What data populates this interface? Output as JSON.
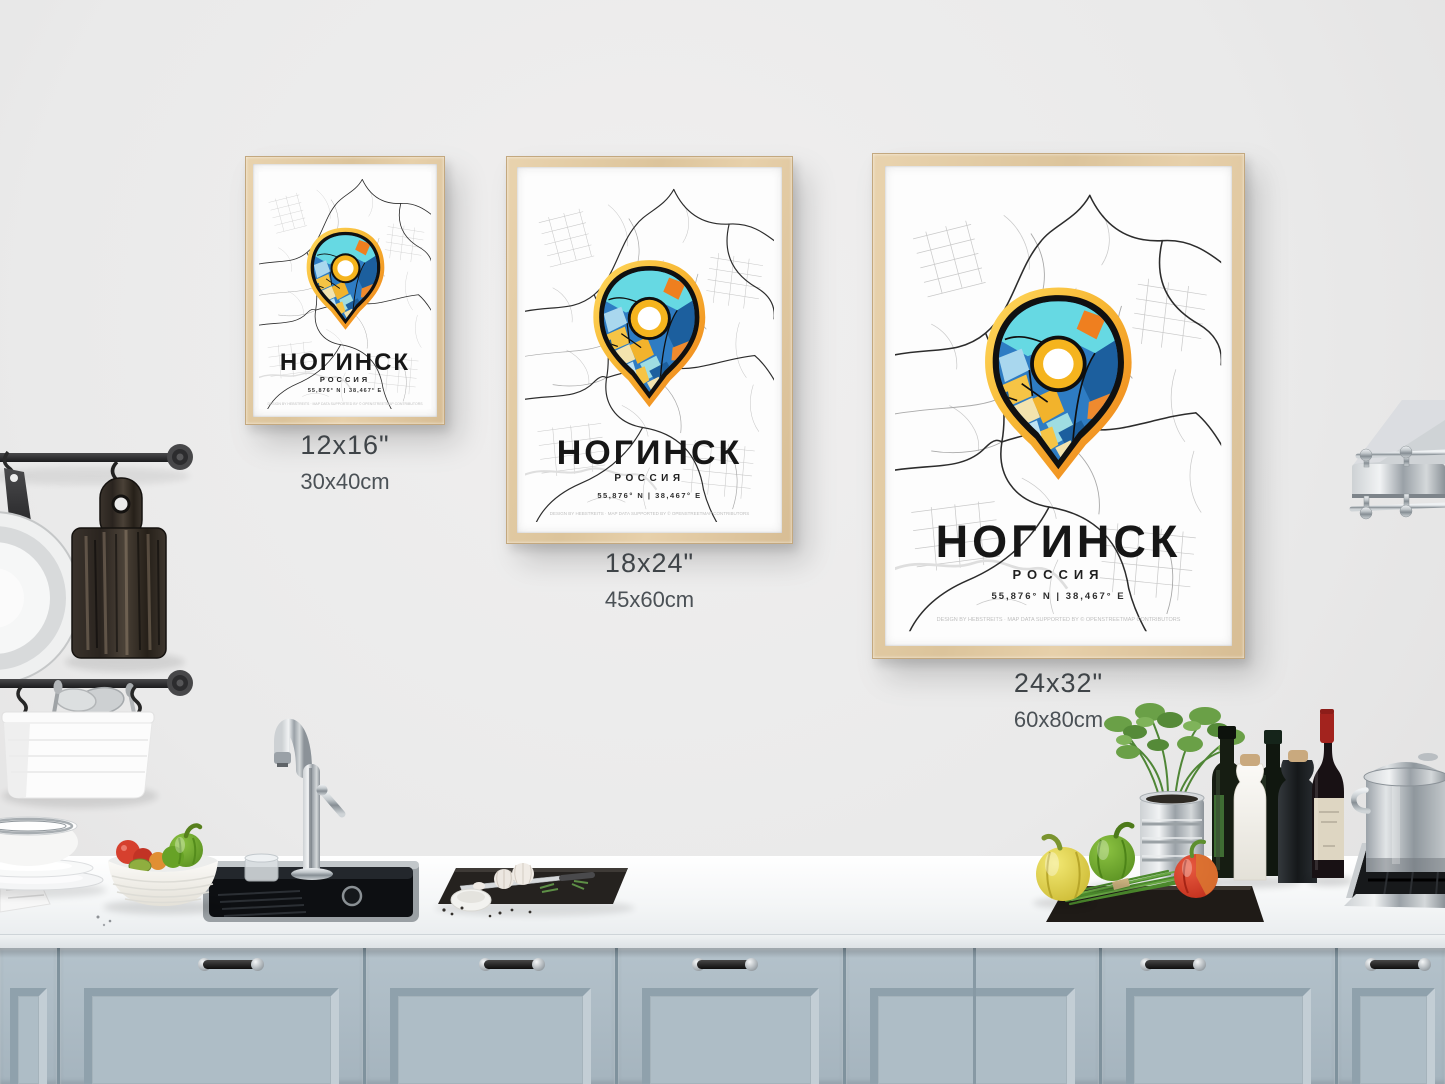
{
  "posters": [
    {
      "id": "small",
      "title": "НОГИНСК",
      "country": "РОССИЯ",
      "coordinates": "55,876° N | 38,467° E",
      "credit": "DESIGN BY HEBSTREITS · MAP DATA SUPPORTED BY © OPENSTREETMAP CONTRIBUTORS",
      "label_inches": "12x16\"",
      "label_cm": "30x40cm"
    },
    {
      "id": "medium",
      "title": "НОГИНСК",
      "country": "РОССИЯ",
      "coordinates": "55,876° N | 38,467° E",
      "credit": "DESIGN BY HEBSTREITS · MAP DATA SUPPORTED BY © OPENSTREETMAP CONTRIBUTORS",
      "label_inches": "18x24\"",
      "label_cm": "45x60cm"
    },
    {
      "id": "large",
      "title": "НОГИНСК",
      "country": "РОССИЯ",
      "coordinates": "55,876° N | 38,467° E",
      "credit": "DESIGN BY HEBSTREITS · MAP DATA SUPPORTED BY © OPENSTREETMAP CONTRIBUTORS",
      "label_inches": "24x32\"",
      "label_cm": "60x80cm"
    }
  ],
  "pin_colors": {
    "glow_yellow": "#ffd95e",
    "glow_orange": "#ee7b17",
    "ring_gold": "#f5b41e",
    "cyan": "#66d9e3",
    "pale_cyan": "#9fdde2",
    "blue": "#2e7cc3",
    "dark_blue": "#1c5f9e",
    "light_blue": "#a9d7ee",
    "yellow": "#f6c445",
    "cream": "#f3e3ae",
    "orange": "#ef7f1f",
    "center_white": "#ffffff"
  },
  "scene_colors": {
    "wall": "#eaeaea",
    "frame_wood": "#e2cba4",
    "cabinet": "#aebdc6",
    "countertop": "#f4f6f7",
    "sink": "#0d0f12"
  }
}
